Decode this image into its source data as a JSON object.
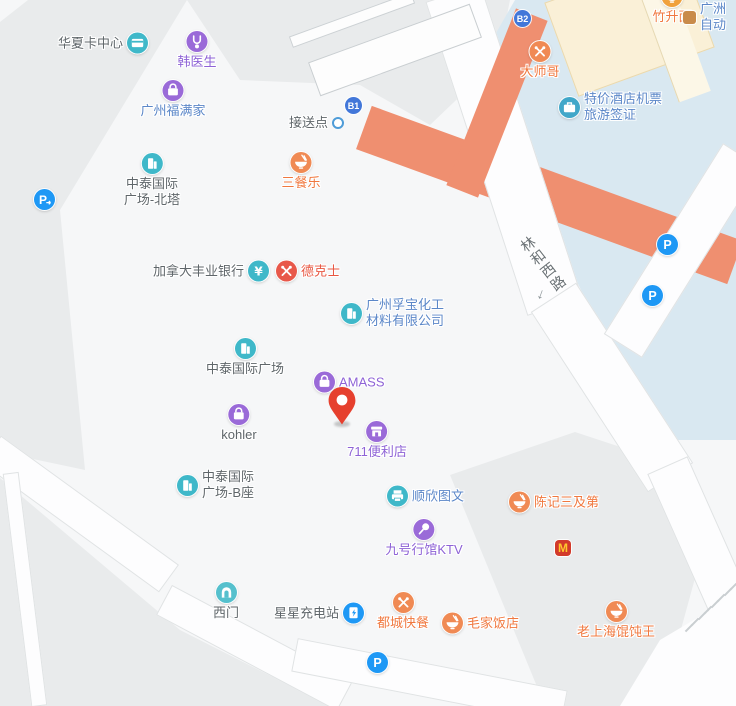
{
  "map_colors": {
    "plaza": "#f6f7f8",
    "block_gray": "#e9ebec",
    "water_blue": "#d9e8f1",
    "road_white": "#fdfdfe",
    "road_orange": "#ef8f70",
    "cream_building": "#faf0d7",
    "teal_icon": "#3fb8c9",
    "purple_icon": "#9a6ad8",
    "orange_icon": "#f08a54",
    "red_icon": "#e8584a",
    "blue_parking": "#1e98f5",
    "badge_blue": "#4277d9",
    "pin_red": "#e6402e"
  },
  "road_label": {
    "text": "林和西路",
    "chars": [
      {
        "c": "林",
        "x": 528,
        "y": 244
      },
      {
        "c": "和",
        "x": 538,
        "y": 257
      },
      {
        "c": "西",
        "x": 548,
        "y": 270
      },
      {
        "c": "路",
        "x": 558,
        "y": 283
      }
    ],
    "arrow": {
      "glyph": "↓",
      "x": 541,
      "y": 294
    }
  },
  "pois": [
    {
      "id": "huaxia-card-center",
      "icon": "card",
      "icon_color": "#3fb8c9",
      "x": 137,
      "y": 43,
      "label": "华夏卡中心",
      "text_color": "#5f666a",
      "layout": "left"
    },
    {
      "id": "han-doctor",
      "icon": "medical",
      "icon_color": "#9a6ad8",
      "x": 197,
      "y": 42,
      "label": "韩医生",
      "text_color": "#8e63d6",
      "layout": "below"
    },
    {
      "id": "guangzhou-fumanjia",
      "icon": "bag",
      "icon_color": "#9a6ad8",
      "x": 173,
      "y": 91,
      "label": "广州福满家",
      "text_color": "#5b87c8",
      "layout": "below"
    },
    {
      "id": "zhongtai-north-tower",
      "icon": "building",
      "icon_color": "#3fb8c9",
      "x": 152,
      "y": 164,
      "label": "中泰国际\n广场-北塔",
      "text_color": "#5f666a",
      "layout": "below"
    },
    {
      "id": "parking-entrance",
      "icon": "parking-arrow",
      "icon_color": "#1e98f5",
      "x": 45,
      "y": 200,
      "label": "",
      "layout": "icononly"
    },
    {
      "id": "pickup-point",
      "icon": "dot",
      "icon_color": "#4e9cd8",
      "x": 333,
      "y": 123,
      "label": "接送点",
      "text_color": "#5f666a",
      "layout": "left"
    },
    {
      "id": "exit-b1",
      "icon": "badge",
      "icon_color": "#4277d9",
      "badge": "B1",
      "x": 356,
      "y": 108,
      "label": "",
      "layout": "icononly"
    },
    {
      "id": "sancanle",
      "icon": "bowl",
      "icon_color": "#f08a54",
      "x": 301,
      "y": 163,
      "label": "三餐乐",
      "text_color": "#f0783f",
      "layout": "below"
    },
    {
      "id": "exit-b2",
      "icon": "badge",
      "icon_color": "#4277d9",
      "badge": "B2",
      "x": 525,
      "y": 21,
      "label": "",
      "layout": "icononly"
    },
    {
      "id": "dashige",
      "icon": "utensils",
      "icon_color": "#f08a54",
      "x": 540,
      "y": 52,
      "label": "大师哥",
      "text_color": "#f0783f",
      "layout": "below"
    },
    {
      "id": "zhushengmian",
      "icon": "bowl",
      "icon_color": "#f0a13c",
      "x": 672,
      "y": -3,
      "label": "竹升面",
      "text_color": "#f0783f",
      "layout": "below"
    },
    {
      "id": "clipped-poi",
      "icon": "minishop",
      "icon_color": "#c98b4a",
      "x": 694,
      "y": 17,
      "label": "广洲\n自动",
      "text_color": "#5b87c8",
      "layout": "right"
    },
    {
      "id": "tejia-hotel-tickets",
      "icon": "suitcase",
      "icon_color": "#41a7c9",
      "x": 570,
      "y": 107,
      "label": "特价酒店机票\n旅游签证",
      "text_color": "#5b87c8",
      "layout": "right"
    },
    {
      "id": "scotiabank",
      "icon": "yen",
      "icon_color": "#3fb8c9",
      "x": 258,
      "y": 271,
      "label": "加拿大丰业银行",
      "text_color": "#5f666a",
      "layout": "left"
    },
    {
      "id": "dicos",
      "icon": "utensils",
      "icon_color": "#e8584a",
      "x": 287,
      "y": 271,
      "label": "德克士",
      "text_color": "#e85742",
      "layout": "right"
    },
    {
      "id": "fubao-chemical",
      "icon": "building",
      "icon_color": "#3fb8c9",
      "x": 352,
      "y": 313,
      "label": "广州孚宝化工\n材料有限公司",
      "text_color": "#5b87c8",
      "layout": "right"
    },
    {
      "id": "zhongtai-plaza",
      "icon": "building",
      "icon_color": "#3fb8c9",
      "x": 245,
      "y": 349,
      "label": "中泰国际广场",
      "text_color": "#5f666a",
      "layout": "below"
    },
    {
      "id": "amass",
      "icon": "bag",
      "icon_color": "#9a6ad8",
      "x": 325,
      "y": 382,
      "label": "AMASS",
      "text_color": "#8e63d6",
      "layout": "right"
    },
    {
      "id": "kohler",
      "icon": "bag",
      "icon_color": "#9a6ad8",
      "x": 239,
      "y": 415,
      "label": "kohler",
      "text_color": "#5f666a",
      "layout": "below"
    },
    {
      "id": "store-711",
      "icon": "store",
      "icon_color": "#9a6ad8",
      "x": 377,
      "y": 432,
      "label": "711便利店",
      "text_color": "#8e63d6",
      "layout": "below"
    },
    {
      "id": "zhongtai-tower-b",
      "icon": "building",
      "icon_color": "#3fb8c9",
      "x": 188,
      "y": 485,
      "label": "中泰国际\n广场-B座",
      "text_color": "#5f666a",
      "layout": "right"
    },
    {
      "id": "shunxin-print",
      "icon": "printer",
      "icon_color": "#3fb8c9",
      "x": 398,
      "y": 496,
      "label": "顺欣图文",
      "text_color": "#5b87c8",
      "layout": "right"
    },
    {
      "id": "chenji-sanjidi",
      "icon": "bowl",
      "icon_color": "#f08a54",
      "x": 520,
      "y": 502,
      "label": "陈记三及第",
      "text_color": "#f0783f",
      "layout": "right"
    },
    {
      "id": "jiuhao-ktv",
      "icon": "mic",
      "icon_color": "#9a6ad8",
      "x": 424,
      "y": 530,
      "label": "九号行馆KTV",
      "text_color": "#8e63d6",
      "layout": "below"
    },
    {
      "id": "mcdonalds",
      "icon": "mcdonalds",
      "icon_color": "#d23a2a",
      "badge": "M",
      "x": 566,
      "y": 551,
      "label": "",
      "layout": "icononly"
    },
    {
      "id": "west-gate",
      "icon": "gate",
      "icon_color": "#55c0cd",
      "x": 226,
      "y": 593,
      "label": "西门",
      "text_color": "#5f666a",
      "layout": "below"
    },
    {
      "id": "xingxing-ev-charging",
      "icon": "ev",
      "icon_color": "#1e98f5",
      "x": 353,
      "y": 613,
      "label": "星星充电站",
      "text_color": "#5f666a",
      "layout": "left"
    },
    {
      "id": "ducheng-fastfood",
      "icon": "utensils",
      "icon_color": "#f08a54",
      "x": 403,
      "y": 603,
      "label": "都城快餐",
      "text_color": "#f0783f",
      "layout": "below"
    },
    {
      "id": "maojia-restaurant",
      "icon": "bowl",
      "icon_color": "#f08a54",
      "x": 453,
      "y": 623,
      "label": "毛家饭店",
      "text_color": "#f0783f",
      "layout": "right"
    },
    {
      "id": "laoshanghai-wonton",
      "icon": "bowl",
      "icon_color": "#f08a54",
      "x": 616,
      "y": 612,
      "label": "老上海馄饨王",
      "text_color": "#f0783f",
      "layout": "below"
    },
    {
      "id": "parking-1",
      "icon": "parking",
      "icon_color": "#1e98f5",
      "x": 668,
      "y": 245,
      "label": "",
      "layout": "icononly"
    },
    {
      "id": "parking-2",
      "icon": "parking",
      "icon_color": "#1e98f5",
      "x": 653,
      "y": 296,
      "label": "",
      "layout": "icononly"
    },
    {
      "id": "parking-3",
      "icon": "parking",
      "icon_color": "#1e98f5",
      "x": 378,
      "y": 663,
      "label": "",
      "layout": "icononly"
    }
  ],
  "pin": {
    "id": "selected-location",
    "x": 342,
    "y": 424
  }
}
